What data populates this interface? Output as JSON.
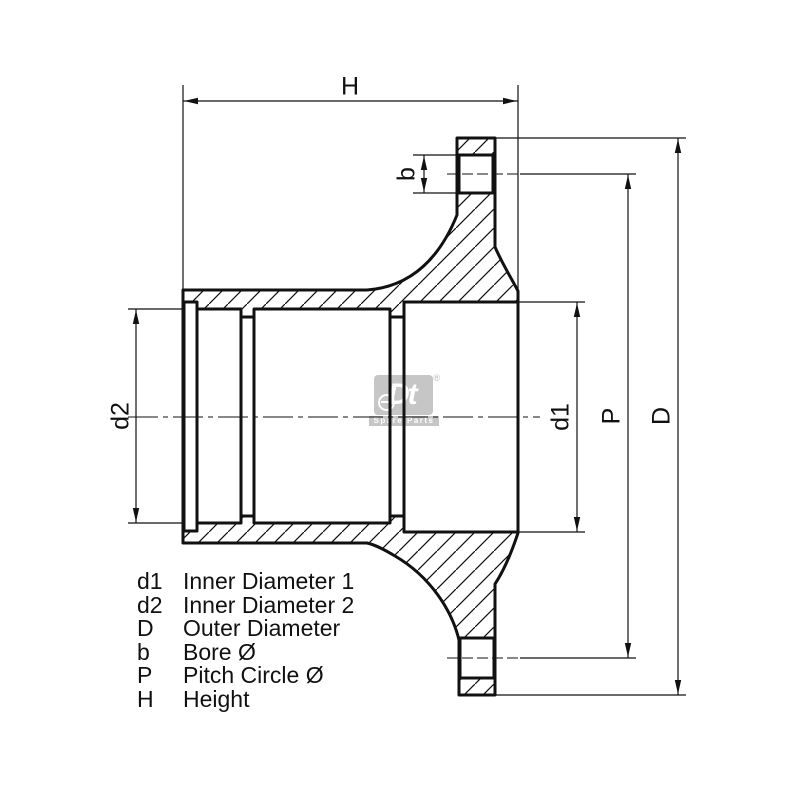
{
  "drawing": {
    "dimension_labels": {
      "H": "H",
      "b": "b",
      "d2": "d2",
      "d1": "d1",
      "P": "P",
      "D": "D"
    }
  },
  "legend": {
    "items": [
      {
        "symbol": "d1",
        "description": "Inner Diameter 1"
      },
      {
        "symbol": "d2",
        "description": "Inner Diameter 2"
      },
      {
        "symbol": "D",
        "description": "Outer Diameter"
      },
      {
        "symbol": "b",
        "description": "Bore Ø"
      },
      {
        "symbol": "P",
        "description": "Pitch Circle Ø"
      },
      {
        "symbol": "H",
        "description": "Height"
      }
    ]
  },
  "watermark": {
    "logo": "Dt",
    "registered": "®",
    "tagline": "Spare Parts"
  },
  "colors": {
    "line": "#111111",
    "watermark_gray": "#c6c6c6"
  }
}
